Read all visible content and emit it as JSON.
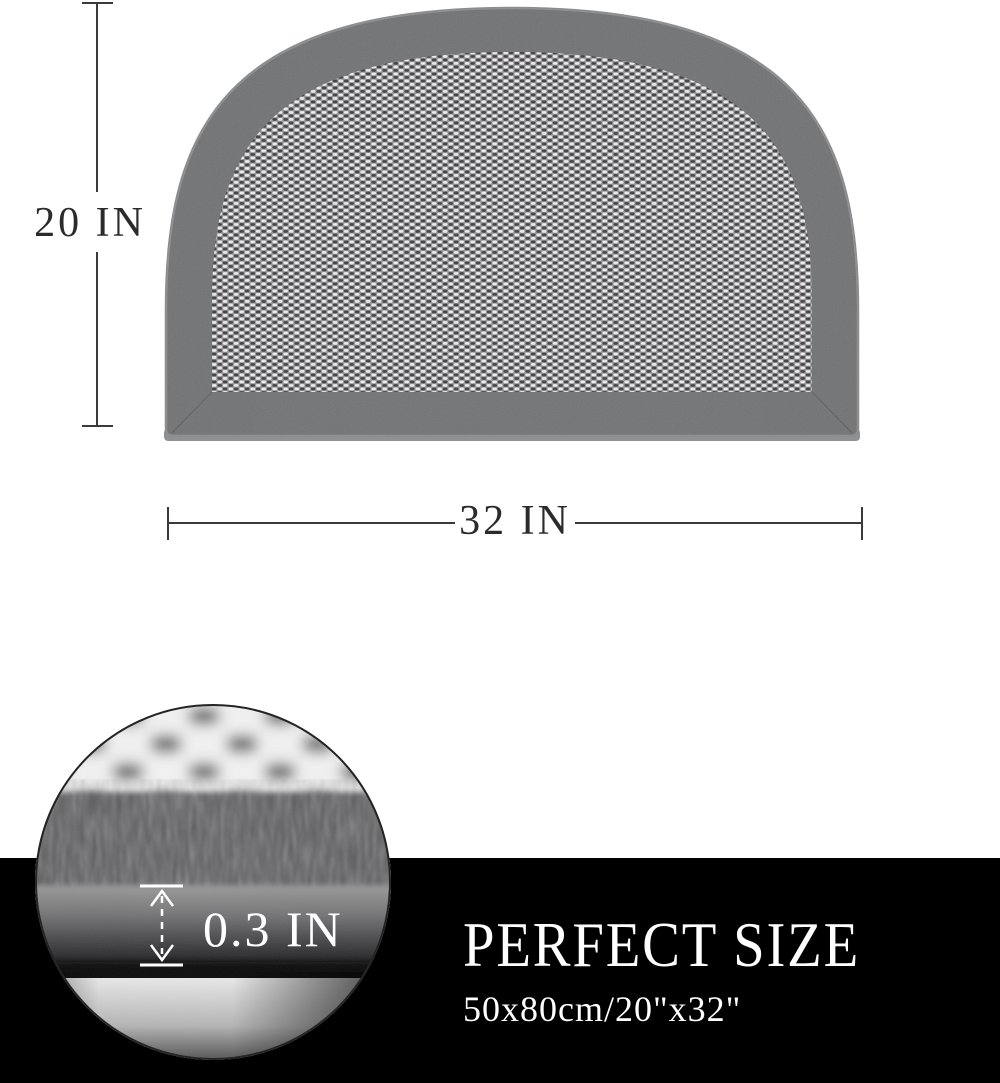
{
  "dimensions": {
    "height_label": "20 IN",
    "width_label": "32 IN",
    "thickness_label": "0.3 IN"
  },
  "banner": {
    "title": "PERFECT SIZE",
    "subtitle": "50x80cm/20\"x32\""
  },
  "colors": {
    "background": "#ffffff",
    "banner_background": "#000000",
    "banner_text": "#ffffff",
    "dimension_line": "#3a3a3a",
    "dimension_text": "#2b2b2b",
    "mat_border": "#707274",
    "mat_binding": "#8f9193",
    "weave_base": "#96969a",
    "weave_light": "#efefed",
    "weave_dark": "#3d3d3f"
  }
}
